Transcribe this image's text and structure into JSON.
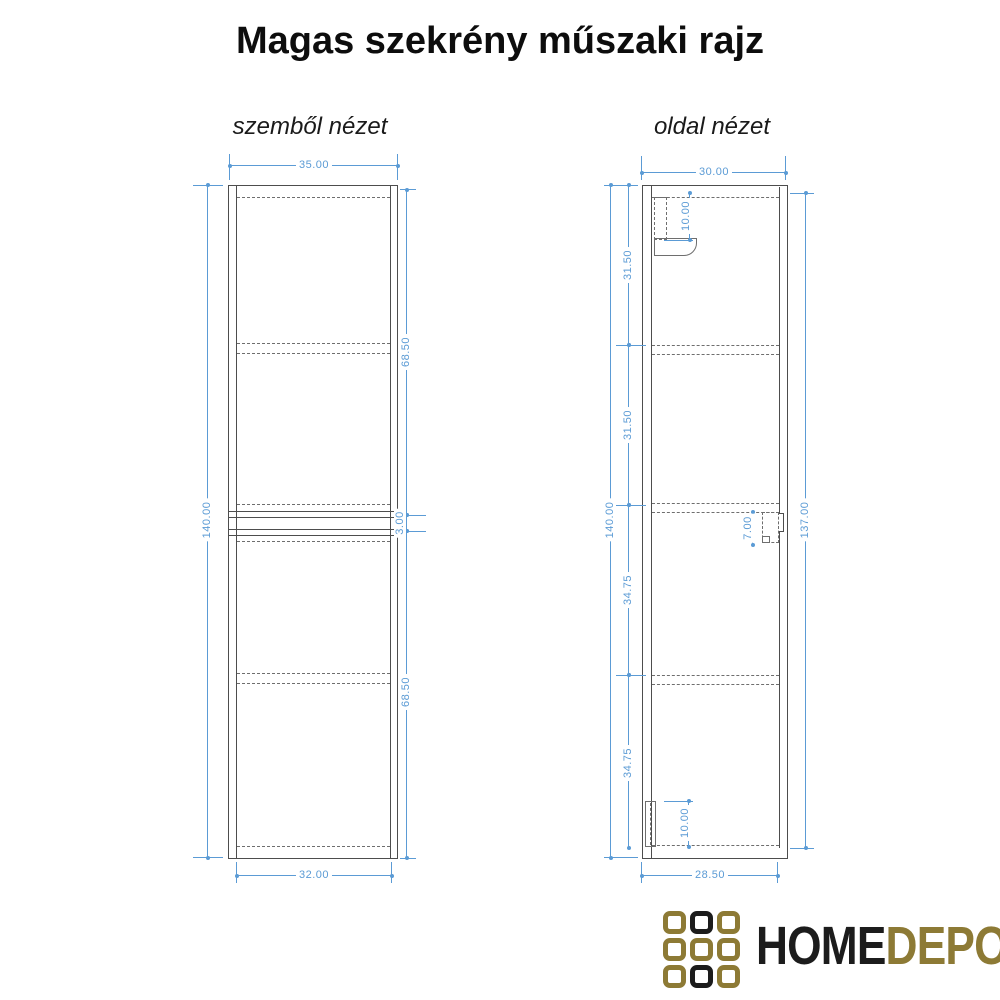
{
  "title": "Magas szekrény műszaki rajz",
  "views": {
    "front": {
      "label": "szemből nézet",
      "dims": {
        "top_width": "35.00",
        "bottom_width": "32.00",
        "height": "140.00",
        "upper_door_height": "68.50",
        "door_gap": "3.00",
        "lower_door_height": "68.50"
      }
    },
    "side": {
      "label": "oldal nézet",
      "dims": {
        "top_depth": "30.00",
        "bottom_depth": "28.50",
        "height": "140.00",
        "front_height": "137.00",
        "section_1": "31.50",
        "section_2": "31.50",
        "section_3": "34.75",
        "section_4": "34.75",
        "top_fitting_depth": "10.00",
        "handle_depth": "7.00",
        "bottom_fitting_height": "10.00"
      }
    }
  },
  "logo": {
    "text_primary": "HOME",
    "text_secondary": "DEPO",
    "colors": {
      "gold": "#8d7a35",
      "black": "#1c1c1c"
    },
    "grid": [
      [
        "gold",
        "black",
        "gold"
      ],
      [
        "gold",
        "gold",
        "gold"
      ],
      [
        "gold",
        "black",
        "gold"
      ]
    ]
  },
  "drawing": {
    "dim_color": "#5b9bd5",
    "line_color": "#4d4d4d"
  }
}
